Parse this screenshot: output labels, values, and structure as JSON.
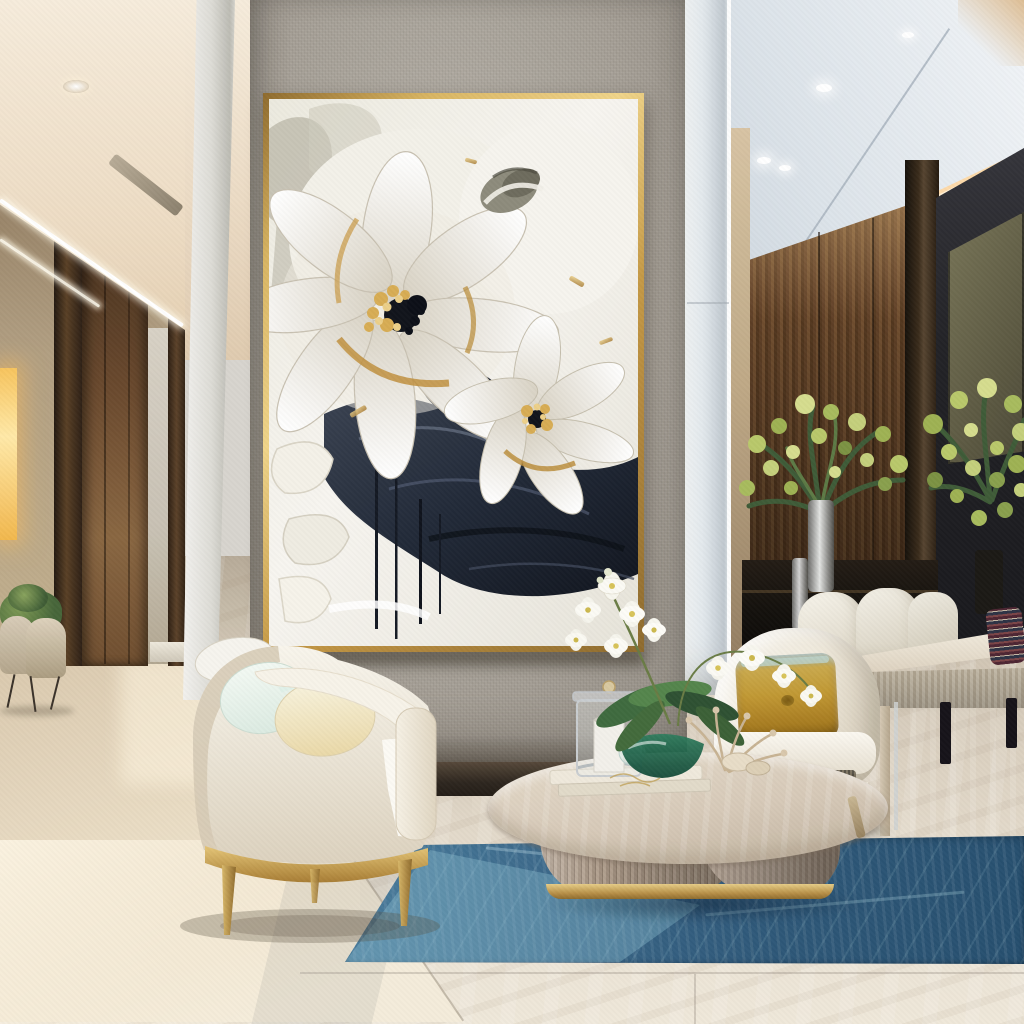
{
  "meta": {
    "type": "interior-photograph",
    "width": 1024,
    "height": 1024,
    "description": "Luxury modern living room: large gold-framed impasto painting of white flowers with gold and navy accents on a grey linen feature wall, cream barrel armchairs with gold legs, round wood coffee table with white orchid, blue area rug on polished marble, wood-panelled media wall with green-yellow flower arrangements, warm cove lighting."
  },
  "labels": {
    "scene": "Living room scene",
    "ceiling_left": "Warm cream ceiling with cove lighting",
    "ceiling_right": "Cool white ceiling with recessed lights",
    "downlight": "Recessed downlight",
    "diffuser": "Linear ceiling diffuser",
    "led_cove": "LED cove light strip",
    "hallway": "Side hallway with tan walls",
    "door": "Walnut wood door",
    "glow_panel": "Backlit amber onyx panel",
    "lounge_chairs_far": "Beige lounge chairs with plant",
    "pilaster": "White wall pilaster",
    "feature_wall": "Grey linen feature wall",
    "painting": "Impasto floral artwork, white petals with gold and navy",
    "painting_frame": "Thin gold picture frame",
    "column": "White structural column",
    "wood_wall": "Walnut slat media wall",
    "tv_panel": "Olive wall-mounted panel",
    "credenza": "Dark media credenza with glass decor",
    "flower_arrangements": "Yellow-green flower arrangements",
    "dining_chairs": "White shell dining chairs",
    "console_table": "Light oak console table",
    "patterned_pillow": "Patterned accent pillow",
    "floor": "Polished beige marble floor",
    "rug": "Steel-blue abstract area rug",
    "armchair_left": "Cream barrel armchair with gold base",
    "armchair_right": "Cream boucle lounge chair",
    "gold_pillow": "Ombre mustard velvet pillow",
    "coffee_table": "Round organic wood coffee table",
    "lantern": "Glass candle lantern",
    "books": "White decor books",
    "orchid": "White phalaenopsis orchid",
    "decor_bowl": "Emerald glass bowl",
    "coral": "Dried coral decor sprig"
  },
  "palette": {
    "ceiling_cream": "#ecdcc6",
    "ceiling_cool": "#d5dde4",
    "cove_warm": "#ffe0ae",
    "wall_tan": "#b2a083",
    "wall_grey_linen": "#a9a39a",
    "pilaster_white": "#e8e8e4",
    "gold_frame": "#c29b4e",
    "canvas_cream": "#f2efe8",
    "paint_navy": "#222a38",
    "paint_gold": "#c9973f",
    "wood_walnut": "#6a4a2c",
    "charcoal_wall": "#232327",
    "tv_olive": "#6b6852",
    "marble_light": "#e9e1d3",
    "marble_warm": "#d9c8ac",
    "rug_blue": "#3a6688",
    "rug_light": "#7fb0c6",
    "chair_cream": "#f2eee3",
    "gold_metal": "#c9a153",
    "pillow_mustard": "#c29a35",
    "plant_green": "#9fb254",
    "leaf_dark": "#3f5c38",
    "onyx_glow": "#ffe9a8",
    "emerald": "#1f6148"
  }
}
